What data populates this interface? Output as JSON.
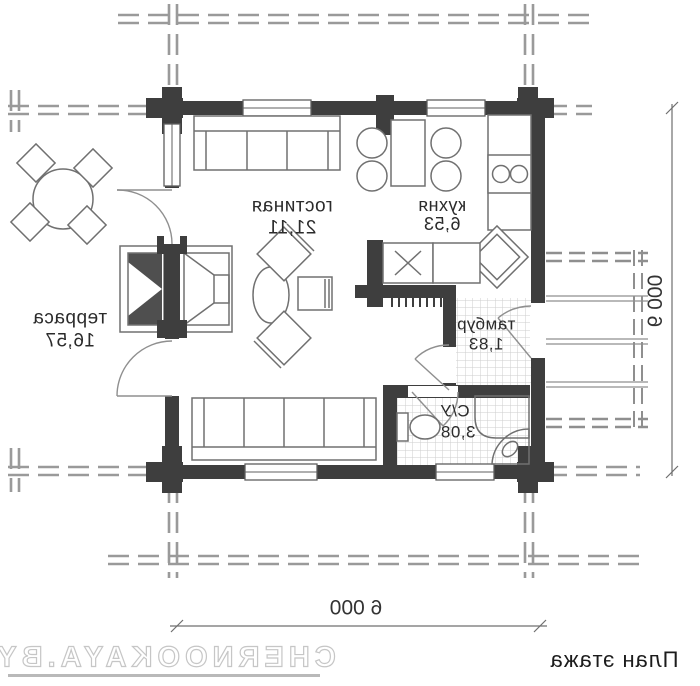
{
  "title": "План этажа",
  "watermark": "CHERNOOKAYA.BY",
  "rooms": [
    {
      "name": "гостиная",
      "area": "21,11"
    },
    {
      "name": "кухня",
      "area": "6,53"
    },
    {
      "name": "терраса",
      "area": "16,57"
    },
    {
      "name": "тамбур",
      "area": "1,83"
    },
    {
      "name": "С/У",
      "area": "3,08"
    }
  ],
  "dimensions": {
    "bottom": "6 000",
    "right": "6 000"
  },
  "colors": {
    "wall": "#3e3e3e",
    "line": "#9a9a9a",
    "furn": "#707070",
    "tile": "#cdcdcd",
    "text": "#2b2b2b",
    "dim": "#6f6f6f",
    "wm": "#c6c6c6",
    "bg": "#ffffff"
  }
}
